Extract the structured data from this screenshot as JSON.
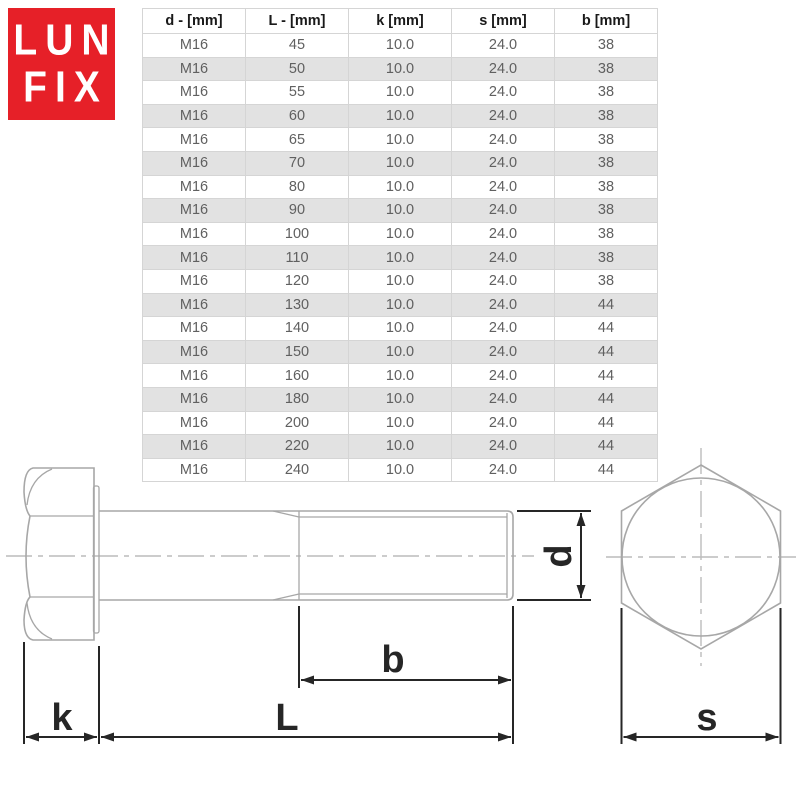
{
  "logo": {
    "line1": "LUN",
    "line2": "FIX",
    "bg_color": "#e62028",
    "text_color": "#ffffff"
  },
  "table": {
    "headers": [
      "d - [mm]",
      "L - [mm]",
      "k [mm]",
      "s [mm]",
      "b [mm]"
    ],
    "rows": [
      [
        "M16",
        "45",
        "10.0",
        "24.0",
        "38"
      ],
      [
        "M16",
        "50",
        "10.0",
        "24.0",
        "38"
      ],
      [
        "M16",
        "55",
        "10.0",
        "24.0",
        "38"
      ],
      [
        "M16",
        "60",
        "10.0",
        "24.0",
        "38"
      ],
      [
        "M16",
        "65",
        "10.0",
        "24.0",
        "38"
      ],
      [
        "M16",
        "70",
        "10.0",
        "24.0",
        "38"
      ],
      [
        "M16",
        "80",
        "10.0",
        "24.0",
        "38"
      ],
      [
        "M16",
        "90",
        "10.0",
        "24.0",
        "38"
      ],
      [
        "M16",
        "100",
        "10.0",
        "24.0",
        "38"
      ],
      [
        "M16",
        "110",
        "10.0",
        "24.0",
        "38"
      ],
      [
        "M16",
        "120",
        "10.0",
        "24.0",
        "38"
      ],
      [
        "M16",
        "130",
        "10.0",
        "24.0",
        "44"
      ],
      [
        "M16",
        "140",
        "10.0",
        "24.0",
        "44"
      ],
      [
        "M16",
        "150",
        "10.0",
        "24.0",
        "44"
      ],
      [
        "M16",
        "160",
        "10.0",
        "24.0",
        "44"
      ],
      [
        "M16",
        "180",
        "10.0",
        "24.0",
        "44"
      ],
      [
        "M16",
        "200",
        "10.0",
        "24.0",
        "44"
      ],
      [
        "M16",
        "220",
        "10.0",
        "24.0",
        "44"
      ],
      [
        "M16",
        "240",
        "10.0",
        "24.0",
        "44"
      ]
    ]
  },
  "diagram": {
    "labels": {
      "k": "k",
      "L": "L",
      "b": "b",
      "d": "d",
      "s": "s"
    },
    "line_color": "#a7a7a7",
    "centerline_color": "#bcbcbc",
    "dimension_color": "#262626"
  }
}
